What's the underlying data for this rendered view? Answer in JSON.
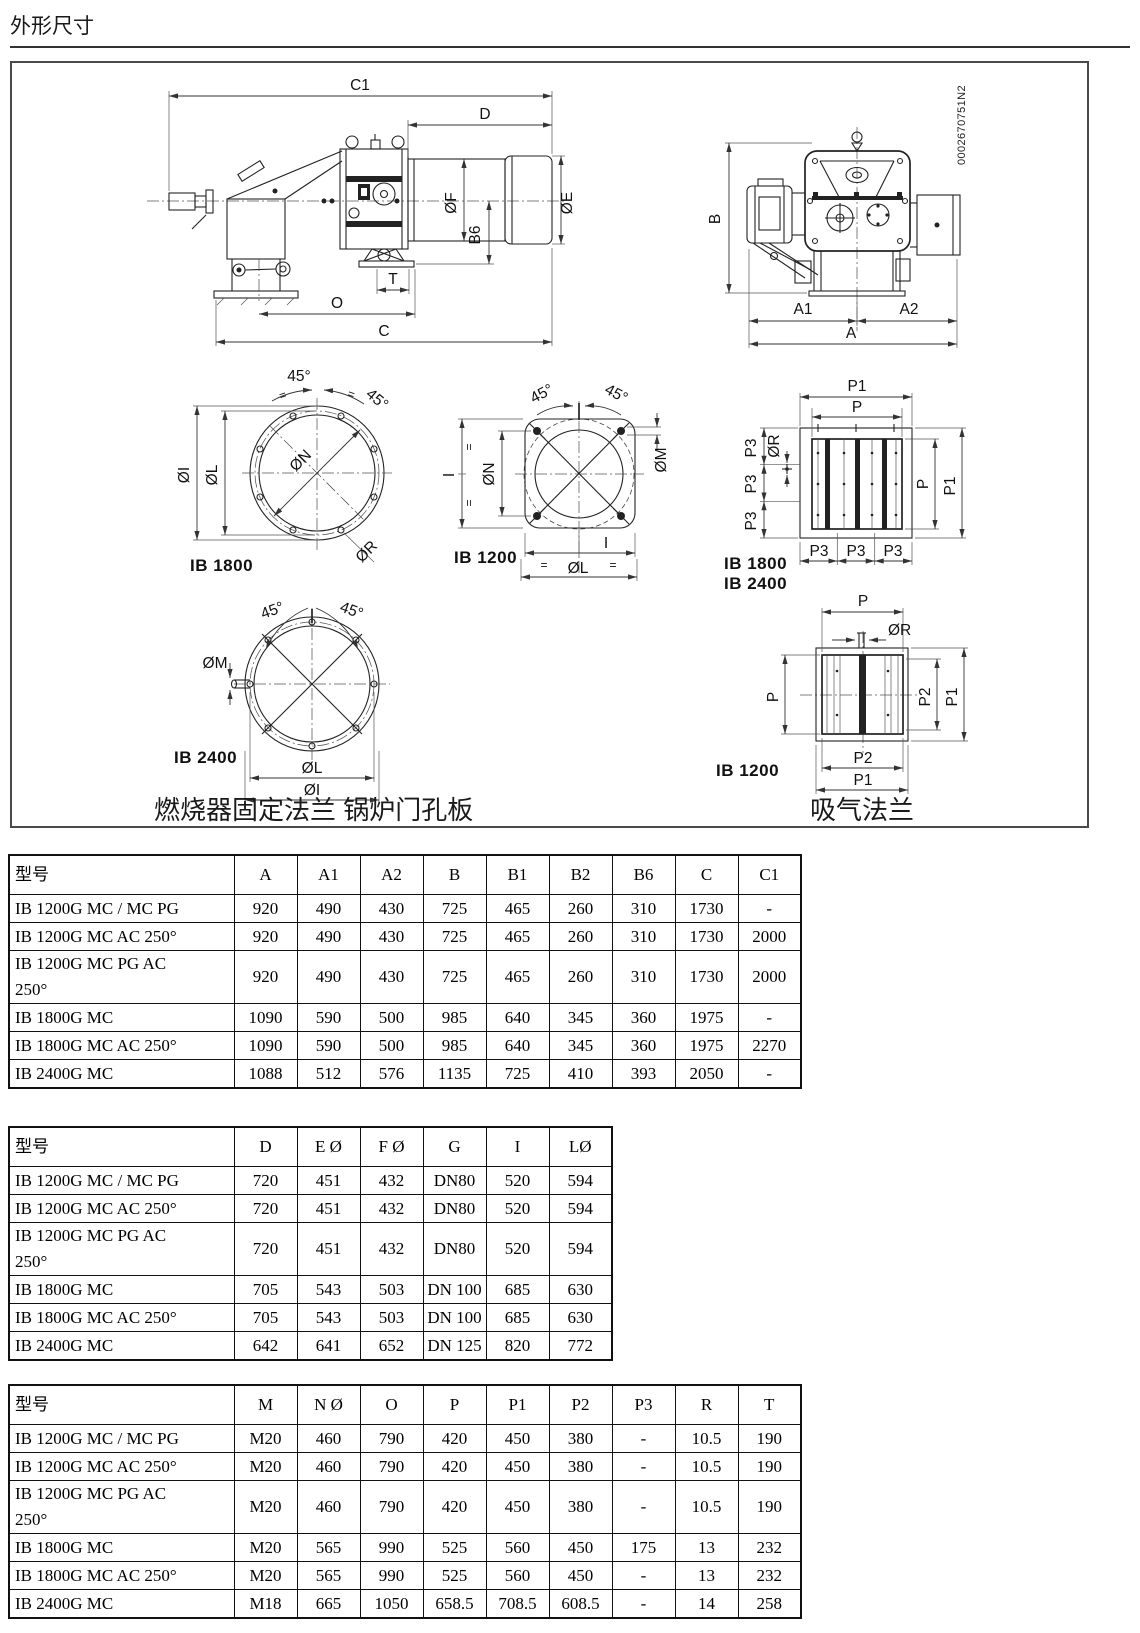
{
  "page": {
    "title": "外形尺寸"
  },
  "figure": {
    "part_code": "0002670751N2",
    "captions": {
      "fixing": "燃烧器固定法兰 锅炉门孔板",
      "suction": "吸气法兰"
    },
    "models": {
      "ib1800": "IB 1800",
      "ib1200": "IB 1200",
      "ib2400": "IB 2400"
    },
    "dims": {
      "c1": "C1",
      "d": "D",
      "f": "ØF",
      "e": "ØE",
      "b6": "B6",
      "t": "T",
      "o": "O",
      "c": "C",
      "b": "B",
      "a1": "A1",
      "a2": "A2",
      "a": "A",
      "deg45": "45°",
      "eq": "=",
      "di": "ØI",
      "dl": "ØL",
      "dn": "ØN",
      "dr": "ØR",
      "dm": "ØM",
      "i": "I",
      "p": "P",
      "p1": "P1",
      "p2": "P2",
      "p3": "P3"
    }
  },
  "tables": [
    {
      "headers": [
        "型号",
        "A",
        "A1",
        "A2",
        "B",
        "B1",
        "B2",
        "B6",
        "C",
        "C1"
      ],
      "rows": [
        [
          "IB 1200G MC / MC PG",
          "920",
          "490",
          "430",
          "725",
          "465",
          "260",
          "310",
          "1730",
          "-"
        ],
        [
          "IB 1200G MC AC 250°",
          "920",
          "490",
          "430",
          "725",
          "465",
          "260",
          "310",
          "1730",
          "2000"
        ],
        [
          "IB 1200G MC PG AC\n250°",
          "920",
          "490",
          "430",
          "725",
          "465",
          "260",
          "310",
          "1730",
          "2000"
        ],
        [
          "IB 1800G MC",
          "1090",
          "590",
          "500",
          "985",
          "640",
          "345",
          "360",
          "1975",
          "-"
        ],
        [
          "IB 1800G MC AC 250°",
          "1090",
          "590",
          "500",
          "985",
          "640",
          "345",
          "360",
          "1975",
          "2270"
        ],
        [
          "IB 2400G MC",
          "1088",
          "512",
          "576",
          "1135",
          "725",
          "410",
          "393",
          "2050",
          "-"
        ]
      ]
    },
    {
      "headers": [
        "型号",
        "D",
        "E Ø",
        "F Ø",
        "G",
        "I",
        "LØ"
      ],
      "rows": [
        [
          "IB 1200G MC / MC PG",
          "720",
          "451",
          "432",
          "DN80",
          "520",
          "594"
        ],
        [
          "IB 1200G MC AC 250°",
          "720",
          "451",
          "432",
          "DN80",
          "520",
          "594"
        ],
        [
          "IB 1200G MC PG AC\n250°",
          "720",
          "451",
          "432",
          "DN80",
          "520",
          "594"
        ],
        [
          "IB 1800G MC",
          "705",
          "543",
          "503",
          "DN 100",
          "685",
          "630"
        ],
        [
          "IB 1800G MC AC 250°",
          "705",
          "543",
          "503",
          "DN 100",
          "685",
          "630"
        ],
        [
          "IB 2400G MC",
          "642",
          "641",
          "652",
          "DN 125",
          "820",
          "772"
        ]
      ]
    },
    {
      "headers": [
        "型号",
        "M",
        "N Ø",
        "O",
        "P",
        "P1",
        "P2",
        "P3",
        "R",
        "T"
      ],
      "rows": [
        [
          "IB 1200G MC / MC PG",
          "M20",
          "460",
          "790",
          "420",
          "450",
          "380",
          "-",
          "10.5",
          "190"
        ],
        [
          "IB 1200G MC AC 250°",
          "M20",
          "460",
          "790",
          "420",
          "450",
          "380",
          "-",
          "10.5",
          "190"
        ],
        [
          "IB 1200G MC PG AC\n250°",
          "M20",
          "460",
          "790",
          "420",
          "450",
          "380",
          "-",
          "10.5",
          "190"
        ],
        [
          "IB 1800G MC",
          "M20",
          "565",
          "990",
          "525",
          "560",
          "450",
          "175",
          "13",
          "232"
        ],
        [
          "IB 1800G MC AC 250°",
          "M20",
          "565",
          "990",
          "525",
          "560",
          "450",
          "-",
          "13",
          "232"
        ],
        [
          "IB 2400G MC",
          "M18",
          "665",
          "1050",
          "658.5",
          "708.5",
          "608.5",
          "-",
          "14",
          "258"
        ]
      ]
    }
  ]
}
